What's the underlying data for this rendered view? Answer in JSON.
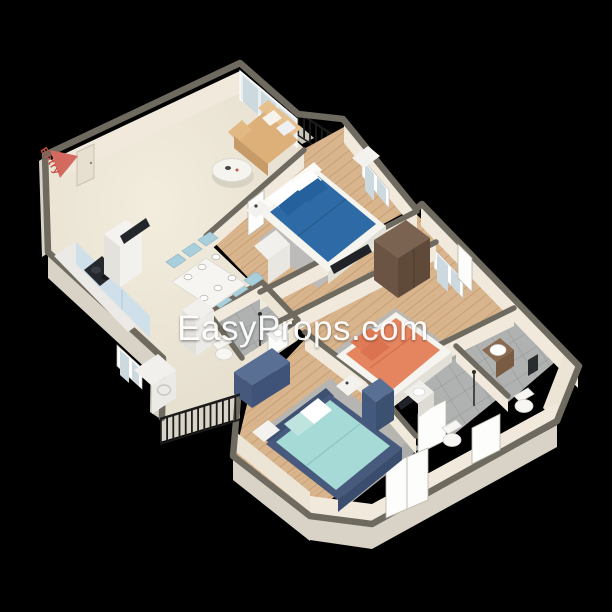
{
  "watermark": {
    "text": "EasyProps.com",
    "color": "#ffffff"
  },
  "entry_marker": {
    "label": "Entry",
    "arrow_color": "#d4695f",
    "label_color": "#c44f43"
  },
  "palette": {
    "background": "#000000",
    "wall_top": "#6f6a5f",
    "wall_face": "#f0e9dc",
    "wall_exterior": "#d8d3c6",
    "floor_cream": "#eae4d7",
    "floor_wood": "#d9b58e",
    "floor_tile": "#b0b2b1",
    "glass": "#ccdae0",
    "railing": "#1c1c1c",
    "bed_blue": "#2e6ba6",
    "bed_orange": "#e58560",
    "bed_teal": "#a5dad6",
    "frame_navy": "#47597c",
    "sofa_tan": "#ddb079",
    "chair_teal": "#a9cfdd",
    "wardrobe_brown": "#6b5443",
    "dresser_navy": "#3e5377",
    "rug_gray": "#bcbcbc"
  }
}
